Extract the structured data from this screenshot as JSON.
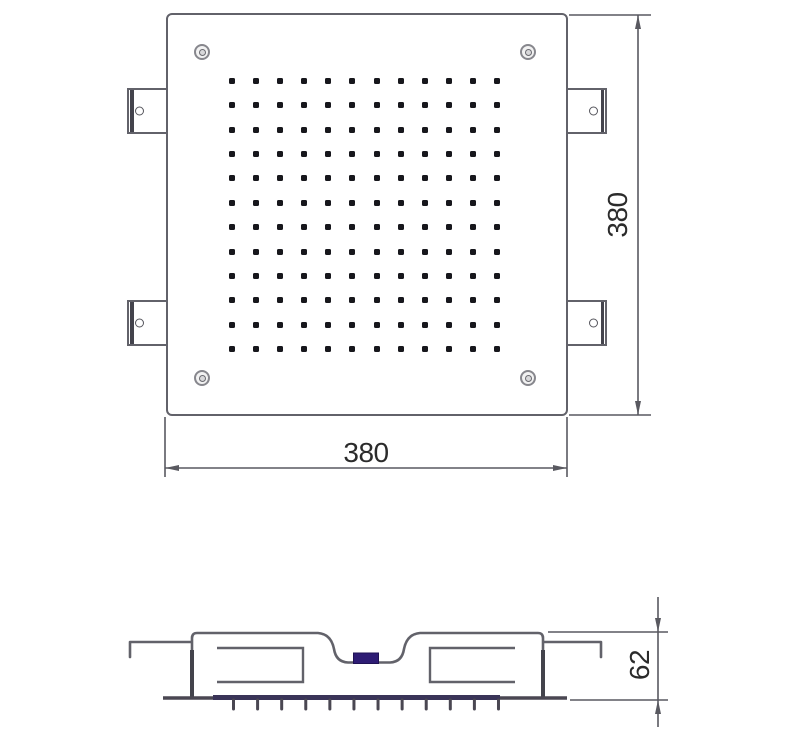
{
  "drawing": {
    "dimension_labels": {
      "width": "380",
      "height": "380",
      "depth": "62"
    },
    "top_view": {
      "nozzle_grid": {
        "rows": 12,
        "cols": 12
      },
      "corner_screw_count": 4,
      "mounting_tab_count": 4
    },
    "side_view": {
      "nozzle_tick_count": 12
    }
  },
  "colors": {
    "background": "#ffffff",
    "line": "#62626a",
    "dark_line": "#43434c",
    "dim_line": "#595960",
    "nozzle_dot": "#17171c",
    "face_plate": "#3a3458",
    "inlet_accent": "#2e1c74",
    "dimension_text": "#2b2b2b"
  }
}
